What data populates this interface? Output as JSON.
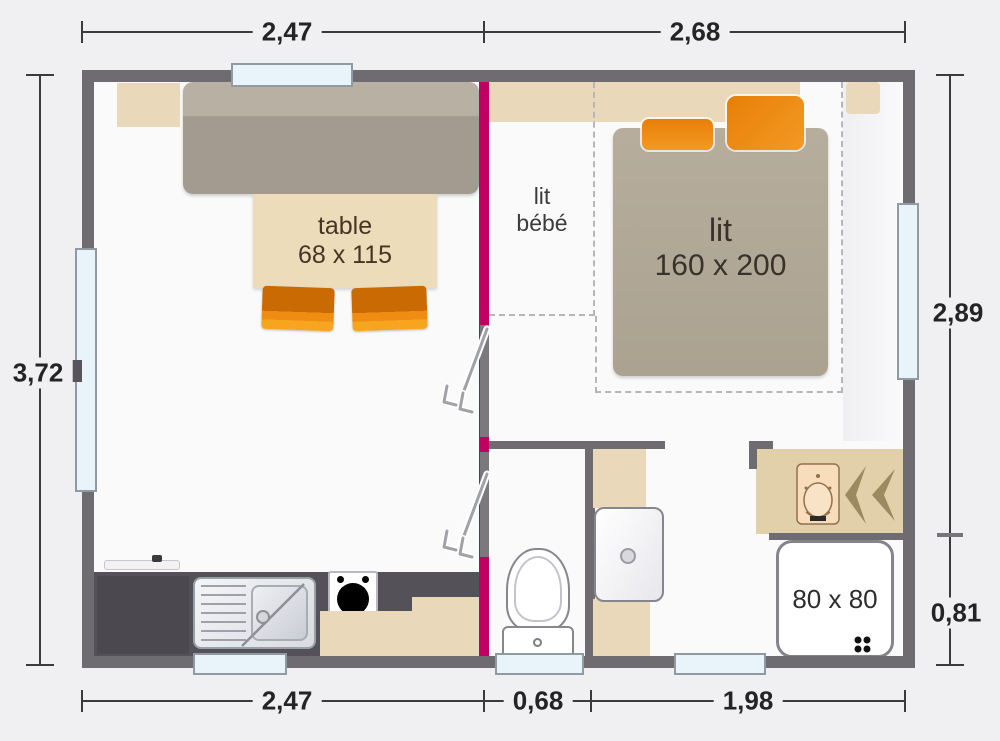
{
  "plan": {
    "dimensions": {
      "top": [
        "2,47",
        "2,68"
      ],
      "bottom": [
        "2,47",
        "0,68",
        "1,98"
      ],
      "left": [
        "3,72"
      ],
      "right": [
        "2,89",
        "0,81"
      ]
    },
    "labels": {
      "table": {
        "name": "table",
        "size": "68 x 115"
      },
      "bed": {
        "name": "lit",
        "size": "160 x 200"
      },
      "baby_bed": {
        "line1": "lit",
        "line2": "bébé"
      },
      "shower": {
        "size": "80 x 80"
      }
    },
    "icons": [
      "window-glazing",
      "door-swing-arrow",
      "toilet",
      "washbasin",
      "kitchen-sink",
      "stove-burner",
      "shower-drain",
      "vanity-basin",
      "double-chevron"
    ],
    "colors": {
      "background": "#f0eff1",
      "wall": "#6e6c71",
      "partition_pink": "#c10063",
      "furniture_beige": "#e9d9ba",
      "upholstery_taupe": "#aca393",
      "accent_orange": "#ee8a12",
      "window_glass": "#e9f3fa",
      "kitchen_counter": "#545258"
    }
  }
}
